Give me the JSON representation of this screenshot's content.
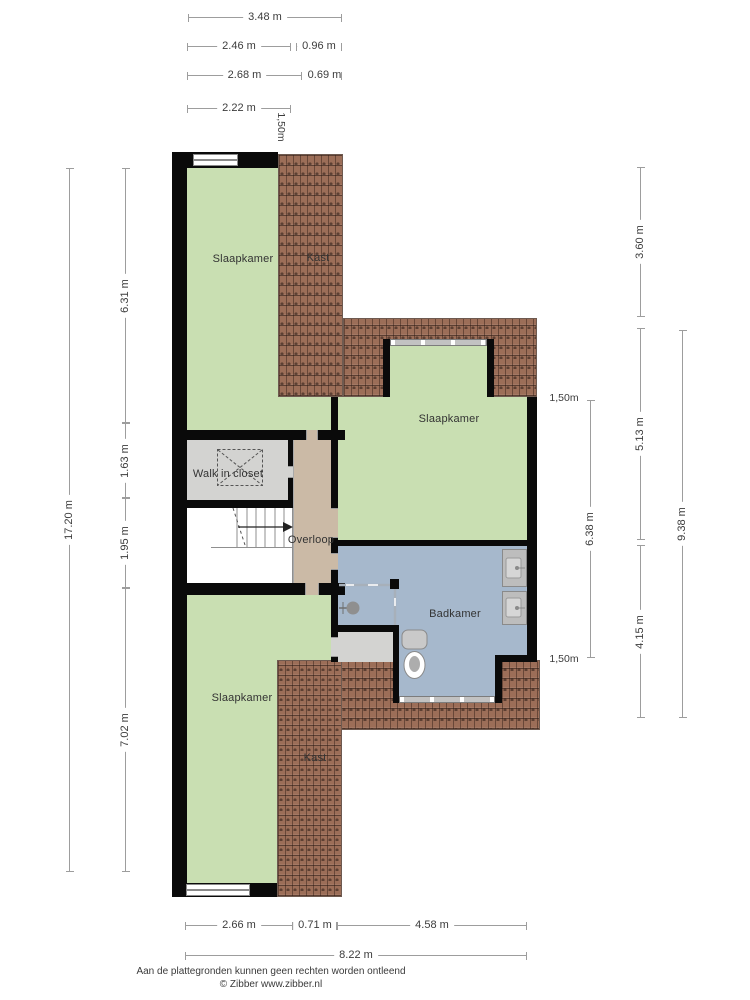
{
  "rooms": {
    "slaapkamer_top": "Slaapkamer",
    "kast_top": "Kast",
    "walk_in_closet": "Walk in closet",
    "overloop": "Overloop",
    "slaapkamer_mid": "Slaapkamer",
    "badkamer": "Badkamer",
    "slaapkamer_bottom": "Slaapkamer",
    "kast_bottom": "Kast"
  },
  "dimensions": {
    "top": [
      "3.48 m",
      "2.46 m",
      "0.96 m",
      "2.68 m",
      "0.69 m",
      "2.22 m"
    ],
    "left": [
      "17.20 m",
      "6.31 m",
      "1.63 m",
      "1.95 m",
      "7.02 m"
    ],
    "right": [
      "3.60 m",
      "5.13 m",
      "4.15 m",
      "9.38 m",
      "6.38 m"
    ],
    "bottom": [
      "2.66 m",
      "0.71 m",
      "4.58 m",
      "8.22 m"
    ],
    "headroom": [
      "1,50m",
      "1,50m",
      "1,50m"
    ]
  },
  "footer": {
    "line1": "Aan de plattegronden kunnen geen rechten worden ontleend",
    "line2": "© Zibber www.zibber.nl"
  },
  "colors": {
    "floor_green": "#c9dfb2",
    "floor_blue": "#a6b8cc",
    "landing_beige": "#cbbaa6",
    "closet_grey": "#d3d3d1",
    "roof_tile": "#9c6e58",
    "wall": "#0a0a0a",
    "dim_line": "#9d9d9d",
    "dim_text": "#3c3c3c",
    "label_text": "#333333",
    "fixture_grey": "#c0c0c0"
  }
}
